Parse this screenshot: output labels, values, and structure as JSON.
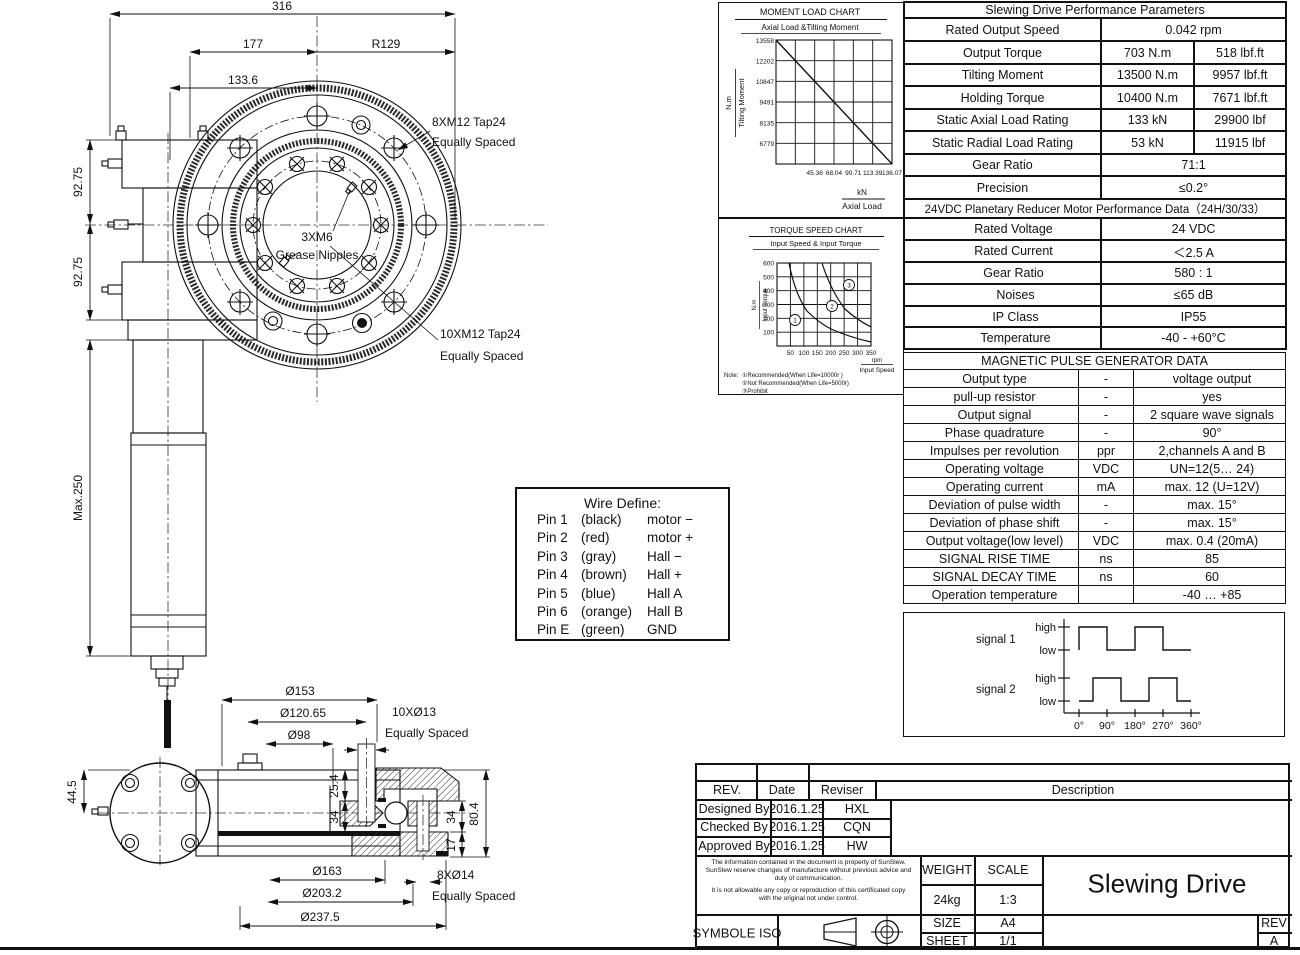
{
  "colors": {
    "ink": "#111111",
    "paper": "#ffffff"
  },
  "top_view": {
    "dims": {
      "d316": "316",
      "d177": "177",
      "r129": "R129",
      "d133_6": "133.6",
      "d92_75_a": "92.75",
      "d92_75_b": "92.75",
      "max250": "Max.250"
    },
    "labels": {
      "bolts8_line1": "8XM12 Tap24",
      "bolts8_line2": "Equally Spaced",
      "grease_line1": "3XM6",
      "grease_line2": "Grease Nipples",
      "bolts10_line1": "10XM12 Tap24",
      "bolts10_line2": "Equally Spaced"
    }
  },
  "side_view": {
    "dims": {
      "d153": "Ø153",
      "d120_65": "Ø120.65",
      "d98": "Ø98",
      "h44_5": "44.5",
      "h25_4": "25.4",
      "h34a": "34",
      "h34b": "34",
      "h17": "17",
      "h80_4": "80.4",
      "d163": "Ø163",
      "d203_2": "Ø203.2",
      "d237_5": "Ø237.5"
    },
    "labels": {
      "holes10_line1": "10XØ13",
      "holes10_line2": "Equally Spaced",
      "holes8_line1": "8XØ14",
      "holes8_line2": "Equally Spaced"
    }
  },
  "wire_define": {
    "title": "Wire Define:",
    "pins": [
      {
        "pin": "Pin 1",
        "color": "(black)",
        "signal": "motor −"
      },
      {
        "pin": "Pin 2",
        "color": "(red)",
        "signal": "motor +"
      },
      {
        "pin": "Pin 3",
        "color": "(gray)",
        "signal": "Hall  −"
      },
      {
        "pin": "Pin 4",
        "color": "(brown)",
        "signal": "Hall +"
      },
      {
        "pin": "Pin 5",
        "color": "(blue)",
        "signal": "Hall A"
      },
      {
        "pin": "Pin 6",
        "color": "(orange)",
        "signal": "Hall B"
      },
      {
        "pin": "Pin E",
        "color": "(green)",
        "signal": "GND"
      }
    ]
  },
  "chart_data": [
    {
      "type": "line",
      "title": "MOMENT LOAD CHART",
      "subtitle": "Axial Load &Tilting Moment",
      "ylabel_unit": "N.m",
      "ylabel": "Tilting Moment",
      "xlabel_unit": "kN",
      "xlabel": "Axial Load",
      "y_ticks": [
        13558,
        12202,
        10847,
        9491,
        8135,
        6779
      ],
      "y_tick_labels": [
        "13558",
        "12202",
        "10847",
        "9491",
        "8135",
        "6779"
      ],
      "x_ticks": [
        45.36,
        68.04,
        90.71,
        113.39,
        136.07
      ],
      "x_tick_labels": [
        "45.36",
        "68.04",
        "90.71",
        "113.39",
        "136.07"
      ],
      "xlim": [
        0,
        136.07
      ],
      "ylim": [
        5423,
        13558
      ],
      "grid": true,
      "series": [
        {
          "name": "tilting-moment-vs-axial-load",
          "x": [
            0,
            136.07
          ],
          "y": [
            13558,
            5423
          ]
        }
      ]
    },
    {
      "type": "line",
      "title": "TORQUE SPEED CHART",
      "subtitle": "Input Speed & Input Torque",
      "ylabel_unit": "N.m",
      "ylabel": "Input Torque",
      "xlabel_unit": "rpm",
      "xlabel": "Input Speed",
      "y_tick_labels": [
        "600",
        "500",
        "400",
        "300",
        "200",
        "100"
      ],
      "x_tick_labels": [
        "50",
        "100",
        "150",
        "200",
        "250",
        "300",
        "350"
      ],
      "xlim": [
        0,
        350
      ],
      "ylim": [
        0,
        600
      ],
      "grid": true,
      "zones": [
        {
          "id": "1",
          "meaning": "Recommended(When Life=10000r )"
        },
        {
          "id": "2",
          "meaning": "Not Recommended(When Life=5000r)"
        },
        {
          "id": "3",
          "meaning": "Prohibit"
        }
      ],
      "note_label": "Note:",
      "notes": [
        "①Recommended(When Life=10000r )",
        "②Not Recommended(When Life=5000r)",
        "③Prohibit"
      ],
      "series": [
        {
          "name": "zone-boundary-1",
          "x": [
            55,
            75,
            100,
            150,
            200,
            250,
            300,
            350
          ],
          "y": [
            600,
            450,
            340,
            230,
            170,
            135,
            112,
            95
          ]
        },
        {
          "name": "zone-boundary-2",
          "x": [
            150,
            175,
            200,
            250,
            300,
            350
          ],
          "y": [
            600,
            500,
            420,
            330,
            265,
            220
          ]
        }
      ]
    },
    {
      "type": "square-wave",
      "signals": [
        {
          "name": "signal 1",
          "high_deg": [
            [
              0,
              90
            ],
            [
              180,
              270
            ]
          ]
        },
        {
          "name": "signal  2",
          "high_deg": [
            [
              45,
              135
            ],
            [
              225,
              315
            ]
          ]
        }
      ],
      "level_labels": {
        "high": "high",
        "low": "low"
      },
      "x_tick_labels": [
        "0°",
        "90°",
        "180°",
        "270°",
        "360°"
      ]
    }
  ],
  "tables": {
    "perf": {
      "title": "Slewing Drive Performance Parameters",
      "rows": [
        {
          "label": "Rated Output Speed",
          "value": "0.042 rpm"
        },
        {
          "label": "Output Torque",
          "metric": "703 N.m",
          "imperial": "518 lbf.ft"
        },
        {
          "label": "Tilting Moment",
          "metric": "13500 N.m",
          "imperial": "9957 lbf.ft"
        },
        {
          "label": "Holding Torque",
          "metric": "10400 N.m",
          "imperial": "7671 lbf.ft"
        },
        {
          "label": "Static Axial Load Rating",
          "metric": "133 kN",
          "imperial": "29900 lbf"
        },
        {
          "label": "Static Radial Load Rating",
          "metric": "53 kN",
          "imperial": "11915 lbf"
        },
        {
          "label": "Gear Ratio",
          "value": "71:1"
        },
        {
          "label": "Precision",
          "value": "≤0.2°"
        }
      ]
    },
    "motor": {
      "title": "24VDC Planetary Reducer Motor Performance Data（24H/30/33）",
      "rows": [
        {
          "label": "Rated Voltage",
          "value": "24 VDC"
        },
        {
          "label": "Rated Current",
          "value": "＜2.5 A"
        },
        {
          "label": "Gear Ratio",
          "value": "580 : 1"
        },
        {
          "label": "Noises",
          "value": "≤65 dB"
        },
        {
          "label": "IP Class",
          "value": "IP55"
        },
        {
          "label": "Temperature",
          "value": "-40 - +60°C"
        }
      ]
    },
    "pulse": {
      "title": "MAGNETIC PULSE GENERATOR DATA",
      "rows": [
        {
          "param": "Output type",
          "unit": "-",
          "value": "voltage output"
        },
        {
          "param": "pull-up resistor",
          "unit": "-",
          "value": "yes"
        },
        {
          "param": "Output signal",
          "unit": "-",
          "value": "2 square wave signals"
        },
        {
          "param": "Phase quadrature",
          "unit": "-",
          "value": "90°"
        },
        {
          "param": "Impulses per revolution",
          "unit": "ppr",
          "value": "2,channels A and B"
        },
        {
          "param": "Operating voltage",
          "unit": "VDC",
          "value": "UN=12(5… 24)"
        },
        {
          "param": "Operating current",
          "unit": "mA",
          "value": "max. 12 (U=12V)"
        },
        {
          "param": "Deviation of pulse width",
          "unit": "-",
          "value": "max. 15°"
        },
        {
          "param": "Deviation of phase shift",
          "unit": "-",
          "value": "max. 15°"
        },
        {
          "param": "Output voltage(low level)",
          "unit": "VDC",
          "value": "max. 0.4 (20mA)"
        },
        {
          "param": "SIGNAL RISE TIME",
          "unit": "ns",
          "value": "85"
        },
        {
          "param": "SIGNAL DECAY TIME",
          "unit": "ns",
          "value": "60"
        },
        {
          "param": "Operation temperature",
          "unit": "",
          "value": "-40 … +85"
        }
      ]
    }
  },
  "title_block": {
    "rev_col": "REV.",
    "date_col": "Date",
    "reviser_col": "Reviser",
    "desc_col": "Description",
    "rows": [
      {
        "role": "Designed By",
        "date": "2016.1.25",
        "name": "HXL"
      },
      {
        "role": "Checked By",
        "date": "2016.1.25",
        "name": "CQN"
      },
      {
        "role": "Approved By",
        "date": "2016.1.25",
        "name": "HW"
      }
    ],
    "disclaimer1": "The information contained in the document is property of SunSlew. SunSlew reserve changes of manufacture without previous advice and duty of communication.",
    "disclaimer2": "It is not allowable any copy or reproduction of this certificated copy with the original not under control.",
    "weight_label": "WEIGHT",
    "scale_label": "SCALE",
    "weight": "24kg",
    "scale": "1:3",
    "drawing_title": "Slewing Drive",
    "symbole": "SYMBOLE ISO",
    "size_label": "SIZE",
    "size": "A4",
    "sheet_label": "SHEET",
    "sheet": "1/1",
    "rev_label": "REV",
    "rev": "A"
  }
}
